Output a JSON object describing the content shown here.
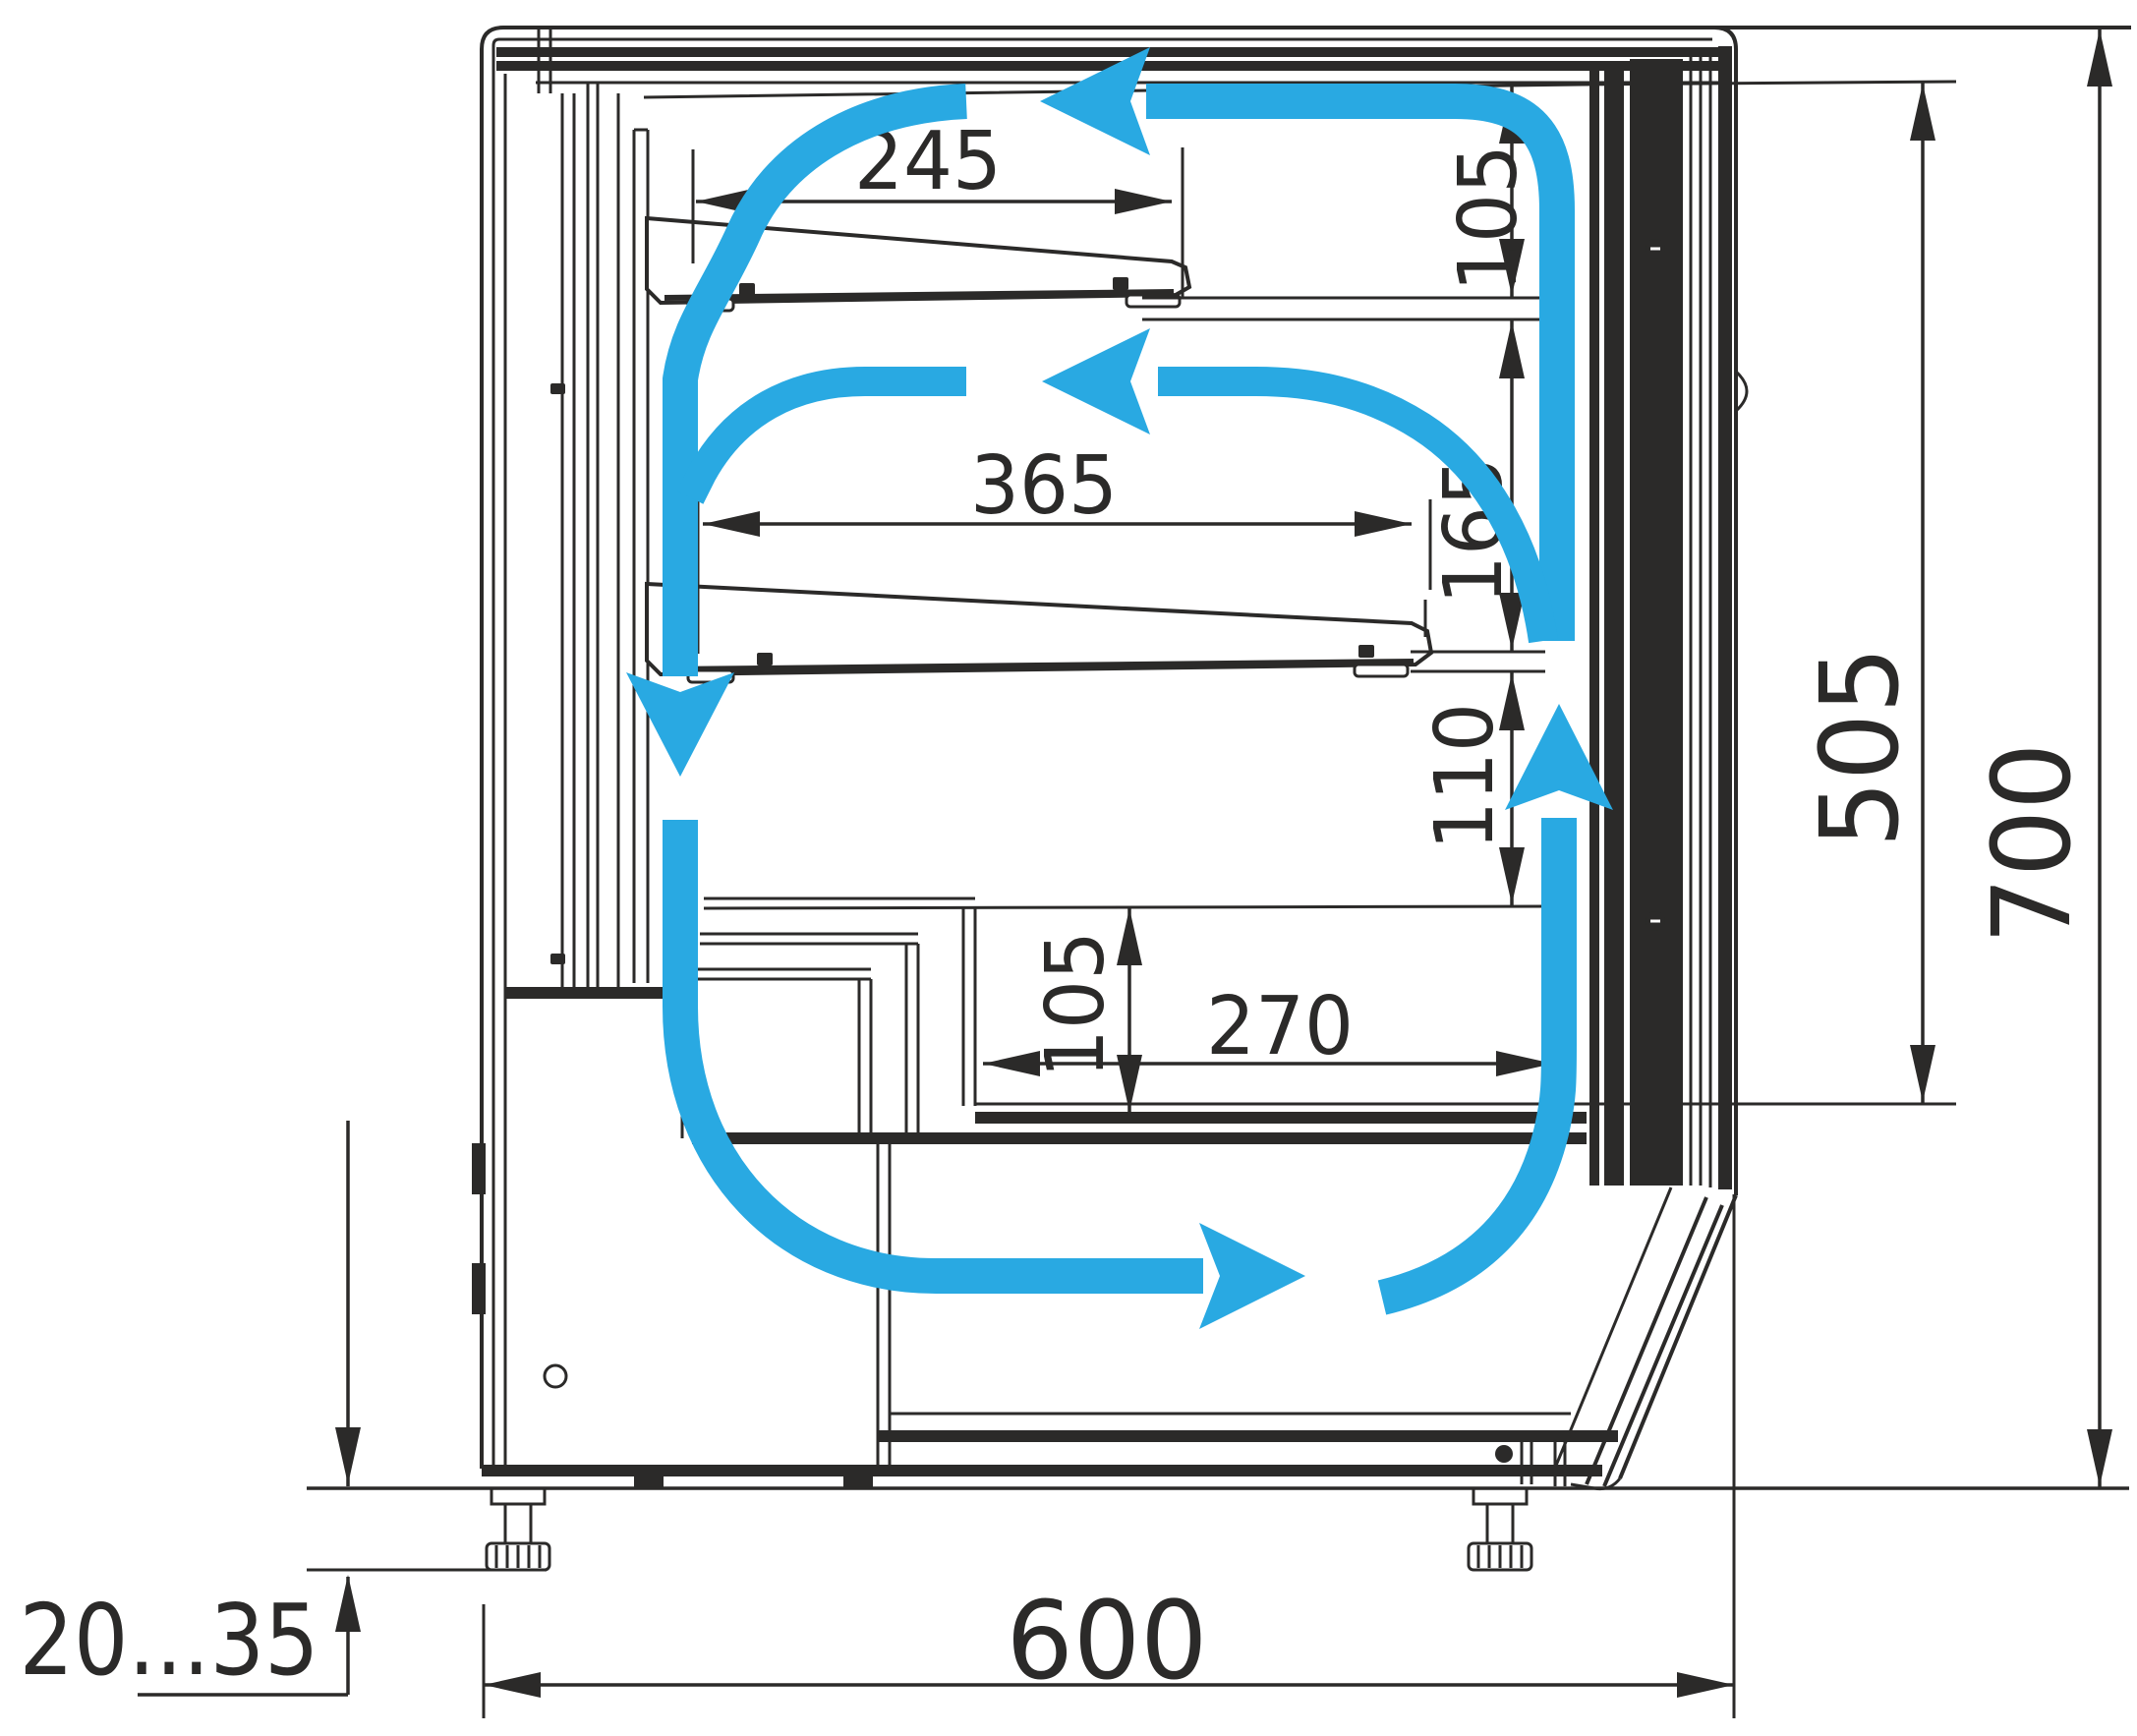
{
  "diagram": {
    "type": "technical-drawing",
    "subject": "Refrigerated display case — side cross-section with air circulation loop and dimensions in mm",
    "ink_color": "#2b2a29",
    "airflow_color": "#29a9e2",
    "background": "#ffffff",
    "dimensions": {
      "top_shelf_depth": "245",
      "middle_shelf_depth": "365",
      "clearance_above_top_shelf": "105",
      "clearance_between_shelves": "165",
      "clearance_below_middle_shelf": "110",
      "well_height": "105",
      "well_depth": "270",
      "interior_height": "505",
      "overall_height": "700",
      "overall_depth": "600",
      "leg_adjustment_range": "20...35"
    },
    "airflow": {
      "pattern": "closed recirculation loop",
      "arrows": [
        "top-flow-left",
        "rear-duct-down",
        "bottom-flow-right",
        "front-riser-up",
        "middle-flow-left"
      ]
    }
  }
}
